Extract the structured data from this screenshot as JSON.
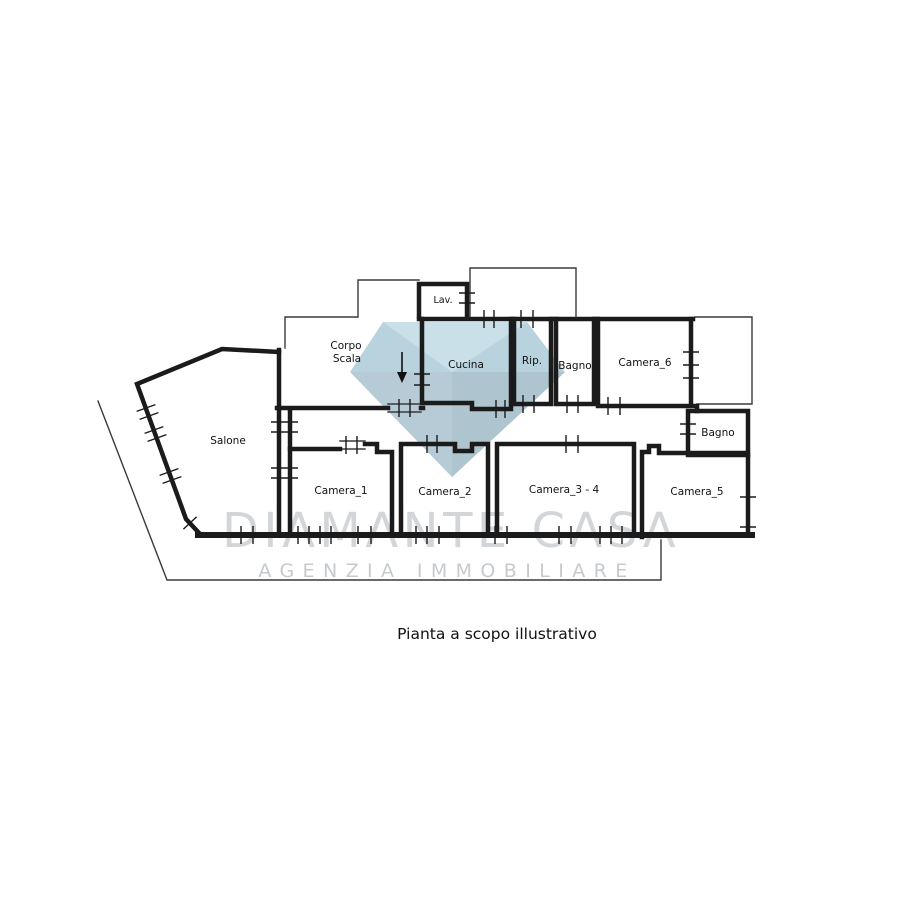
{
  "plan": {
    "caption": "Pianta a scopo illustrativo",
    "rooms": [
      {
        "id": "lav",
        "label": "Lav."
      },
      {
        "id": "corpo_scala",
        "label": "Corpo Scala",
        "line1": "Corpo",
        "line2": "Scala"
      },
      {
        "id": "cucina",
        "label": "Cucina"
      },
      {
        "id": "rip",
        "label": "Rip."
      },
      {
        "id": "bagno_top",
        "label": "Bagno"
      },
      {
        "id": "camera_6",
        "label": "Camera_6"
      },
      {
        "id": "bagno_right",
        "label": "Bagno"
      },
      {
        "id": "salone",
        "label": "Salone"
      },
      {
        "id": "camera_1",
        "label": "Camera_1"
      },
      {
        "id": "camera_2",
        "label": "Camera_2"
      },
      {
        "id": "camera_3_4",
        "label": "Camera_3 - 4"
      },
      {
        "id": "camera_5",
        "label": "Camera_5"
      }
    ]
  },
  "watermark": {
    "brand": "DIAMANTE CASA",
    "tagline": "AGENZIA IMMOBILIARE",
    "diamond": {
      "crown": "#b8d3de",
      "table": "#c9e0e8",
      "pavilion": "#b6cbd6",
      "pavilion_dark": "#aec5d0"
    }
  },
  "colors": {
    "wall": "#1b1b1b",
    "background": "#ffffff",
    "brand_text": "#d3d6d9",
    "tagline_text": "#c6cacd"
  }
}
